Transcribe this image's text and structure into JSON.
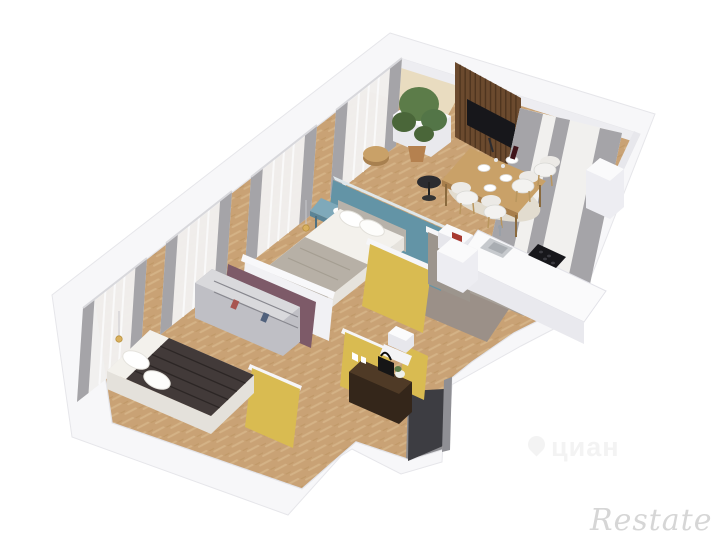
{
  "canvas": {
    "width": 725,
    "height": 544,
    "background": "#ffffff"
  },
  "watermarks": {
    "brand": "Restate",
    "portal": "циан",
    "portal_icon": "pin-icon",
    "brand_color": "#d6d6d6",
    "portal_color": "#f3f3f3"
  },
  "palette": {
    "wall_top": "#f7f7f9",
    "wall_edge": "#e6e6ea",
    "wall_inner_shade": "#ededf1",
    "floor_wood": "#c9a275",
    "floor_wood_light": "#dcc094",
    "floor_wood_dark": "#b8905c",
    "balcony_floor": "#e9dcc0",
    "tile_warm": "#9b9088",
    "tile_entry": "#8e8e92",
    "door_dark": "#3d3d42",
    "accent_yellow": "#d9bb51",
    "accent_blue": "#6394a6",
    "accent_blue_light": "#7fa9ba",
    "accent_purple": "#7d5a68",
    "wood_dark": "#6b4a2e",
    "slat_line": "#4f351f",
    "tv_black": "#17171b",
    "curtain_light": "#f1f0ee",
    "curtain_gray": "#a5a4a8",
    "table_wood": "#c9a168",
    "table_wood_dark": "#a87f4c",
    "plant_green": "#5c7c49",
    "plant_green_dark": "#4a6639",
    "pot_tan": "#b5814f",
    "textile_white": "#f3f1ec",
    "textile_gray": "#b7b0a6",
    "bed_dark": "#423a39",
    "bed_dark_line": "#2c2625",
    "dresser_top": "#d9d9dc",
    "dresser_front": "#bfbfc5",
    "dresser_side": "#abacb2",
    "counter_white": "#fafafb",
    "counter_side": "#e9e9ee",
    "console_brown": "#4f3a26",
    "console_front": "#34261a",
    "gold": "#d9b05e",
    "red_accent": "#a83a31",
    "blue_small": "#41598c"
  }
}
